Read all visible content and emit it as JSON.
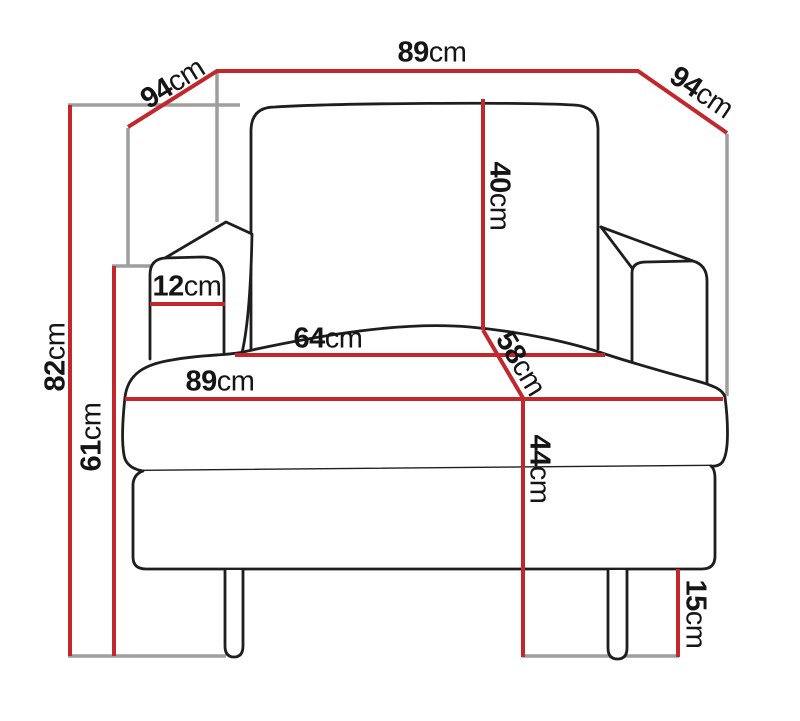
{
  "figure": {
    "type": "furniture-dimension-diagram",
    "subject": "armchair front view with measurements"
  },
  "colors": {
    "dimension_red": "#c1272d",
    "guide_gray": "#9e9e9e",
    "outline_black": "#1e1e1e",
    "background": "#ffffff"
  },
  "dims": {
    "top_width": {
      "value": "89",
      "unit": "cm"
    },
    "depth_left": {
      "value": "94",
      "unit": "cm"
    },
    "depth_right": {
      "value": "94",
      "unit": "cm"
    },
    "backrest_height": {
      "value": "40",
      "unit": "cm"
    },
    "armrest_width": {
      "value": "12",
      "unit": "cm"
    },
    "seat_inner_width": {
      "value": "64",
      "unit": "cm"
    },
    "seat_depth": {
      "value": "58",
      "unit": "cm"
    },
    "seat_width": {
      "value": "89",
      "unit": "cm"
    },
    "total_height": {
      "value": "82",
      "unit": "cm"
    },
    "armrest_height": {
      "value": "61",
      "unit": "cm"
    },
    "seat_height": {
      "value": "44",
      "unit": "cm"
    },
    "leg_height": {
      "value": "15",
      "unit": "cm"
    }
  }
}
